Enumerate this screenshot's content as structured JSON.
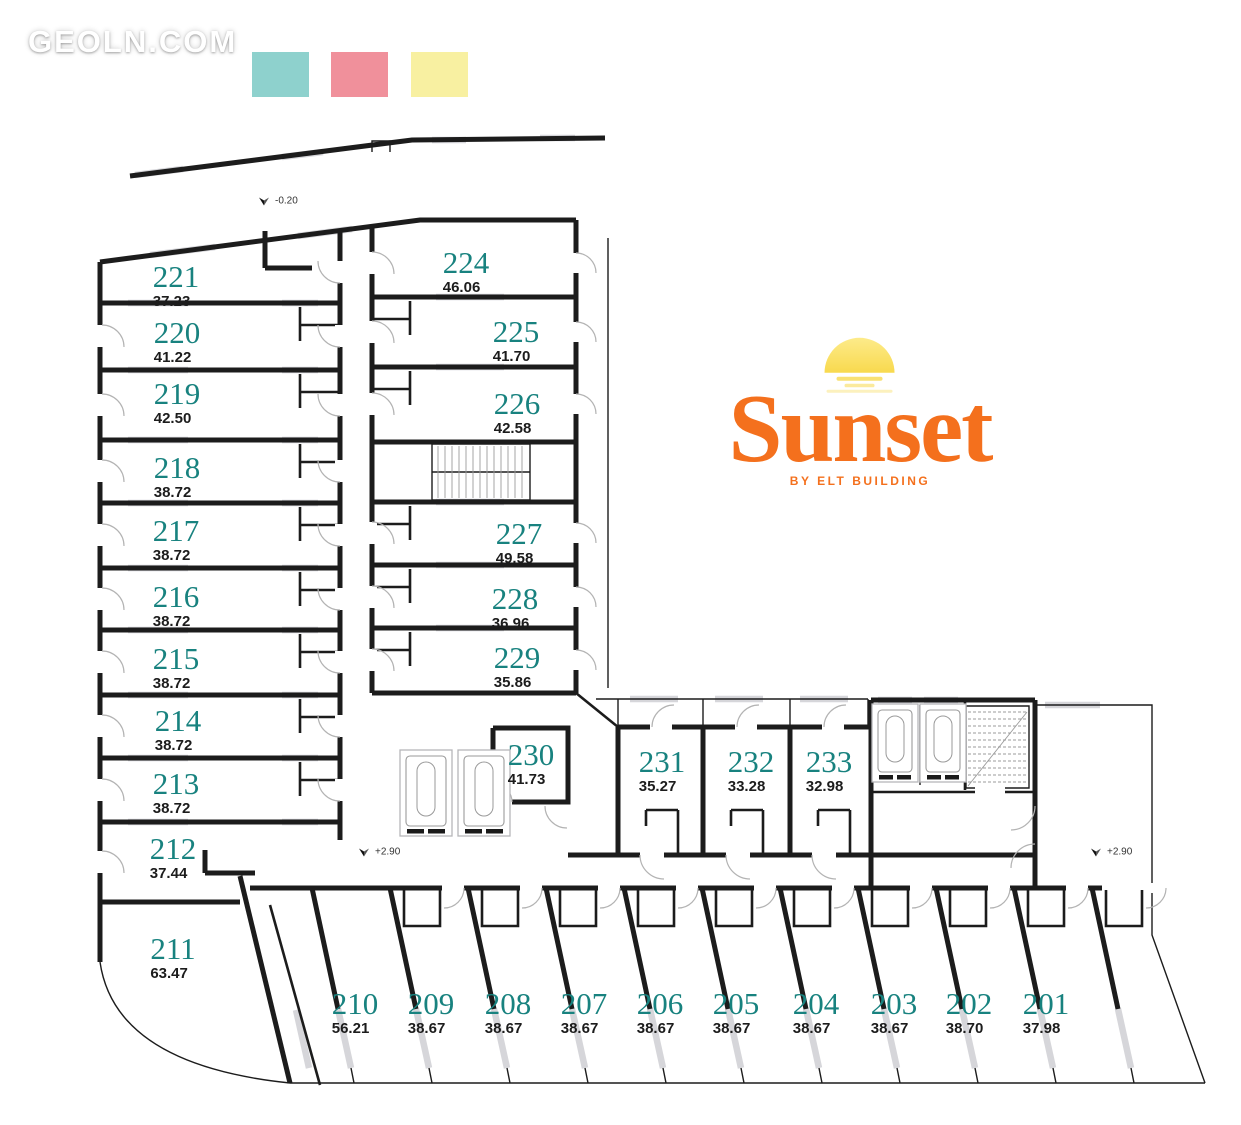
{
  "watermark": {
    "text": "GEOLN.COM"
  },
  "legend": {
    "swatches": [
      {
        "name": "teal-swatch",
        "color": "#8ed1cd"
      },
      {
        "name": "pink-swatch",
        "color": "#f0909b"
      },
      {
        "name": "yellow-swatch",
        "color": "#f8f0a1"
      }
    ]
  },
  "logo": {
    "name": "Sunset",
    "tagline": "BY ELT BUILDING",
    "accent": "#f4701d",
    "sun": "#fbe169"
  },
  "colors": {
    "room_number": "#18827f",
    "area_text": "#1c1c1c",
    "wall": "#1c1c1c",
    "window": "#d6d6da"
  },
  "elevations": [
    {
      "label": "-0.20",
      "x": 258,
      "y": 201
    },
    {
      "label": "+2.90",
      "x": 358,
      "y": 852
    },
    {
      "label": "+2.90",
      "x": 1090,
      "y": 852
    }
  ],
  "rooms": [
    {
      "number": "221",
      "area": "37.23",
      "x": 176,
      "y": 285
    },
    {
      "number": "220",
      "area": "41.22",
      "x": 177,
      "y": 341
    },
    {
      "number": "219",
      "area": "42.50",
      "x": 177,
      "y": 402
    },
    {
      "number": "218",
      "area": "38.72",
      "x": 177,
      "y": 476
    },
    {
      "number": "217",
      "area": "38.72",
      "x": 176,
      "y": 539
    },
    {
      "number": "216",
      "area": "38.72",
      "x": 176,
      "y": 605
    },
    {
      "number": "215",
      "area": "38.72",
      "x": 176,
      "y": 667
    },
    {
      "number": "214",
      "area": "38.72",
      "x": 178,
      "y": 729
    },
    {
      "number": "213",
      "area": "38.72",
      "x": 176,
      "y": 792
    },
    {
      "number": "212",
      "area": "37.44",
      "x": 173,
      "y": 857
    },
    {
      "number": "211",
      "area": "63.47",
      "x": 173,
      "y": 957
    },
    {
      "number": "224",
      "area": "46.06",
      "x": 466,
      "y": 271
    },
    {
      "number": "225",
      "area": "41.70",
      "x": 516,
      "y": 340
    },
    {
      "number": "226",
      "area": "42.58",
      "x": 517,
      "y": 412
    },
    {
      "number": "227",
      "area": "49.58",
      "x": 519,
      "y": 542
    },
    {
      "number": "228",
      "area": "36.96",
      "x": 515,
      "y": 607
    },
    {
      "number": "229",
      "area": "35.86",
      "x": 517,
      "y": 666
    },
    {
      "number": "230",
      "area": "41.73",
      "x": 531,
      "y": 763
    },
    {
      "number": "231",
      "area": "35.27",
      "x": 662,
      "y": 770
    },
    {
      "number": "232",
      "area": "33.28",
      "x": 751,
      "y": 770
    },
    {
      "number": "233",
      "area": "32.98",
      "x": 829,
      "y": 770
    },
    {
      "number": "210",
      "area": "56.21",
      "x": 355,
      "y": 1012
    },
    {
      "number": "209",
      "area": "38.67",
      "x": 431,
      "y": 1012
    },
    {
      "number": "208",
      "area": "38.67",
      "x": 508,
      "y": 1012
    },
    {
      "number": "207",
      "area": "38.67",
      "x": 584,
      "y": 1012
    },
    {
      "number": "206",
      "area": "38.67",
      "x": 660,
      "y": 1012
    },
    {
      "number": "205",
      "area": "38.67",
      "x": 736,
      "y": 1012
    },
    {
      "number": "204",
      "area": "38.67",
      "x": 816,
      "y": 1012
    },
    {
      "number": "203",
      "area": "38.67",
      "x": 894,
      "y": 1012
    },
    {
      "number": "202",
      "area": "38.70",
      "x": 969,
      "y": 1012
    },
    {
      "number": "201",
      "area": "37.98",
      "x": 1046,
      "y": 1012
    }
  ]
}
